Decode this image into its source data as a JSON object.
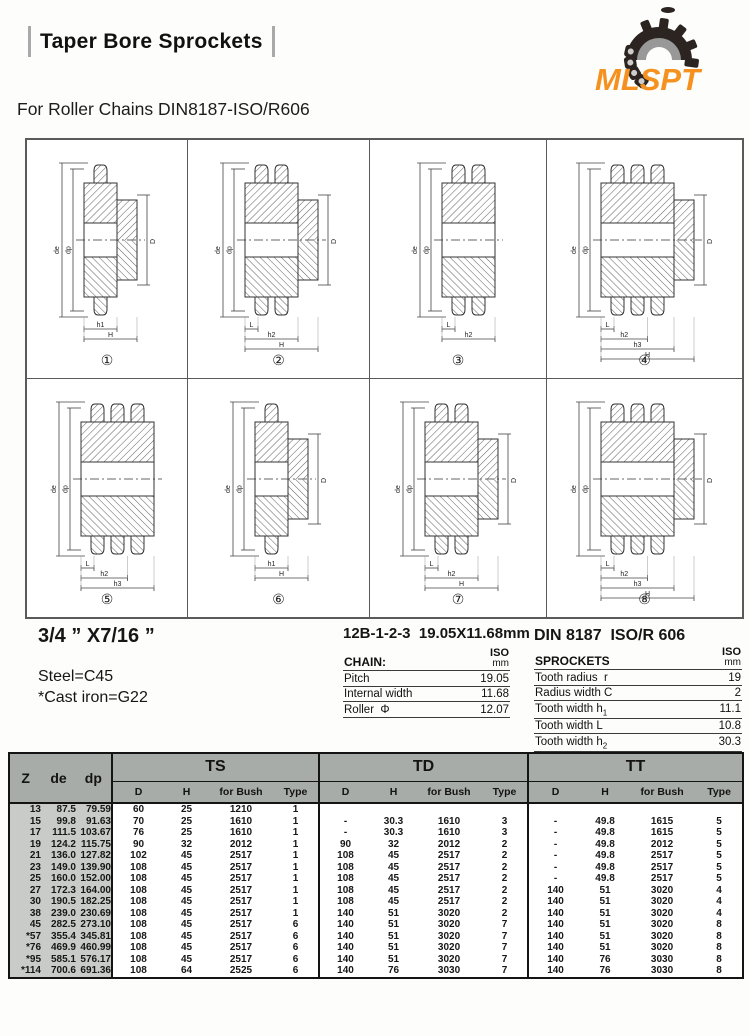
{
  "header": {
    "title": "Taper Bore Sprockets",
    "brand": "MLSPT",
    "subtitle": "For Roller Chains DIN8187-ISO/R606"
  },
  "specs": {
    "size": "3/4 ” X7/16 ”",
    "material_steel": "Steel=C45",
    "material_cast": "*Cast iron=G22",
    "chain_designation": "12B-1-2-3  19.05X11.68mm",
    "standard": "DIN 8187  ISO/R 606"
  },
  "chain_table": {
    "title": "CHAIN:",
    "unit_line1": "ISO",
    "unit_line2": "mm",
    "rows": [
      {
        "label": "Pitch",
        "sub": "",
        "value": "19.05"
      },
      {
        "label": "Internal width",
        "sub": "",
        "value": "11.68"
      },
      {
        "label": "Roller  Φ",
        "sub": "",
        "value": "12.07"
      }
    ]
  },
  "sprockets_table": {
    "title": "SPROCKETS",
    "unit_line1": "ISO",
    "unit_line2": "mm",
    "rows": [
      {
        "label": "Tooth radius  r",
        "sub": "",
        "value": "19"
      },
      {
        "label": "Radius width C",
        "sub": "",
        "value": "2"
      },
      {
        "label": "Tooth width h",
        "sub": "1",
        "value": "11.1"
      },
      {
        "label": "Tooth width L",
        "sub": "",
        "value": "10.8"
      },
      {
        "label": "Tooth width h",
        "sub": "2",
        "value": "30.3"
      },
      {
        "label": "Tooth width h",
        "sub": "3",
        "value": "49.8"
      }
    ]
  },
  "diagrams": [
    {
      "num": "①",
      "rows": 1,
      "hub": true,
      "dims": [
        "de",
        "dp",
        "D",
        "h1",
        "H"
      ]
    },
    {
      "num": "②",
      "rows": 2,
      "hub": true,
      "dims": [
        "de",
        "dp",
        "D",
        "L",
        "h2",
        "H"
      ]
    },
    {
      "num": "③",
      "rows": 2,
      "hub": false,
      "dims": [
        "de",
        "dp",
        "L",
        "h2"
      ]
    },
    {
      "num": "④",
      "rows": 3,
      "hub": true,
      "dims": [
        "de",
        "dp",
        "D",
        "L",
        "h2",
        "h3",
        "H"
      ]
    },
    {
      "num": "⑤",
      "rows": 3,
      "hub": false,
      "dims": [
        "de",
        "dp",
        "L",
        "h2",
        "h3"
      ]
    },
    {
      "num": "⑥",
      "rows": 1,
      "hub": true,
      "dims": [
        "de",
        "dp",
        "D",
        "h1",
        "H"
      ]
    },
    {
      "num": "⑦",
      "rows": 2,
      "hub": true,
      "dims": [
        "de",
        "dp",
        "D",
        "L",
        "h2",
        "H"
      ]
    },
    {
      "num": "⑧",
      "rows": 3,
      "hub": true,
      "dims": [
        "de",
        "dp",
        "D",
        "L",
        "h2",
        "h3",
        "H"
      ]
    }
  ],
  "main_table": {
    "left_headers": [
      "Z",
      "de",
      "dp"
    ],
    "groups": [
      "TS",
      "TD",
      "TT"
    ],
    "sub_headers": [
      "D",
      "H",
      "for Bush",
      "Type"
    ],
    "rows": [
      {
        "z": "13",
        "de": "87.5",
        "dp": "79.59",
        "ts": [
          "60",
          "25",
          "1210",
          "1"
        ],
        "td": [
          "",
          "",
          "",
          ""
        ],
        "tt": [
          "",
          "",
          "",
          ""
        ]
      },
      {
        "z": "15",
        "de": "99.8",
        "dp": "91.63",
        "ts": [
          "70",
          "25",
          "1610",
          "1"
        ],
        "td": [
          "-",
          "30.3",
          "1610",
          "3"
        ],
        "tt": [
          "-",
          "49.8",
          "1615",
          "5"
        ]
      },
      {
        "z": "17",
        "de": "111.5",
        "dp": "103.67",
        "ts": [
          "76",
          "25",
          "1610",
          "1"
        ],
        "td": [
          "-",
          "30.3",
          "1610",
          "3"
        ],
        "tt": [
          "-",
          "49.8",
          "1615",
          "5"
        ]
      },
      {
        "z": "19",
        "de": "124.2",
        "dp": "115.75",
        "ts": [
          "90",
          "32",
          "2012",
          "1"
        ],
        "td": [
          "90",
          "32",
          "2012",
          "2"
        ],
        "tt": [
          "-",
          "49.8",
          "2012",
          "5"
        ]
      },
      {
        "z": "21",
        "de": "136.0",
        "dp": "127.82",
        "ts": [
          "102",
          "45",
          "2517",
          "1"
        ],
        "td": [
          "108",
          "45",
          "2517",
          "2"
        ],
        "tt": [
          "-",
          "49.8",
          "2517",
          "5"
        ]
      },
      {
        "z": "23",
        "de": "149.0",
        "dp": "139.90",
        "ts": [
          "108",
          "45",
          "2517",
          "1"
        ],
        "td": [
          "108",
          "45",
          "2517",
          "2"
        ],
        "tt": [
          "-",
          "49.8",
          "2517",
          "5"
        ]
      },
      {
        "z": "25",
        "de": "160.0",
        "dp": "152.00",
        "ts": [
          "108",
          "45",
          "2517",
          "1"
        ],
        "td": [
          "108",
          "45",
          "2517",
          "2"
        ],
        "tt": [
          "-",
          "49.8",
          "2517",
          "5"
        ]
      },
      {
        "z": "27",
        "de": "172.3",
        "dp": "164.00",
        "ts": [
          "108",
          "45",
          "2517",
          "1"
        ],
        "td": [
          "108",
          "45",
          "2517",
          "2"
        ],
        "tt": [
          "140",
          "51",
          "3020",
          "4"
        ]
      },
      {
        "z": "30",
        "de": "190.5",
        "dp": "182.25",
        "ts": [
          "108",
          "45",
          "2517",
          "1"
        ],
        "td": [
          "108",
          "45",
          "2517",
          "2"
        ],
        "tt": [
          "140",
          "51",
          "3020",
          "4"
        ]
      },
      {
        "z": "38",
        "de": "239.0",
        "dp": "230.69",
        "ts": [
          "108",
          "45",
          "2517",
          "1"
        ],
        "td": [
          "140",
          "51",
          "3020",
          "2"
        ],
        "tt": [
          "140",
          "51",
          "3020",
          "4"
        ]
      },
      {
        "z": "45",
        "de": "282.5",
        "dp": "273.10",
        "ts": [
          "108",
          "45",
          "2517",
          "6"
        ],
        "td": [
          "140",
          "51",
          "3020",
          "7"
        ],
        "tt": [
          "140",
          "51",
          "3020",
          "8"
        ]
      },
      {
        "z": "*57",
        "de": "355.4",
        "dp": "345.81",
        "ts": [
          "108",
          "45",
          "2517",
          "6"
        ],
        "td": [
          "140",
          "51",
          "3020",
          "7"
        ],
        "tt": [
          "140",
          "51",
          "3020",
          "8"
        ]
      },
      {
        "z": "*76",
        "de": "469.9",
        "dp": "460.99",
        "ts": [
          "108",
          "45",
          "2517",
          "6"
        ],
        "td": [
          "140",
          "51",
          "3020",
          "7"
        ],
        "tt": [
          "140",
          "51",
          "3020",
          "8"
        ]
      },
      {
        "z": "*95",
        "de": "585.1",
        "dp": "576.17",
        "ts": [
          "108",
          "45",
          "2517",
          "6"
        ],
        "td": [
          "140",
          "51",
          "3020",
          "7"
        ],
        "tt": [
          "140",
          "76",
          "3030",
          "8"
        ]
      },
      {
        "z": "*114",
        "de": "700.6",
        "dp": "691.36",
        "ts": [
          "108",
          "64",
          "2525",
          "6"
        ],
        "td": [
          "140",
          "76",
          "3030",
          "7"
        ],
        "tt": [
          "140",
          "76",
          "3030",
          "8"
        ]
      }
    ]
  }
}
